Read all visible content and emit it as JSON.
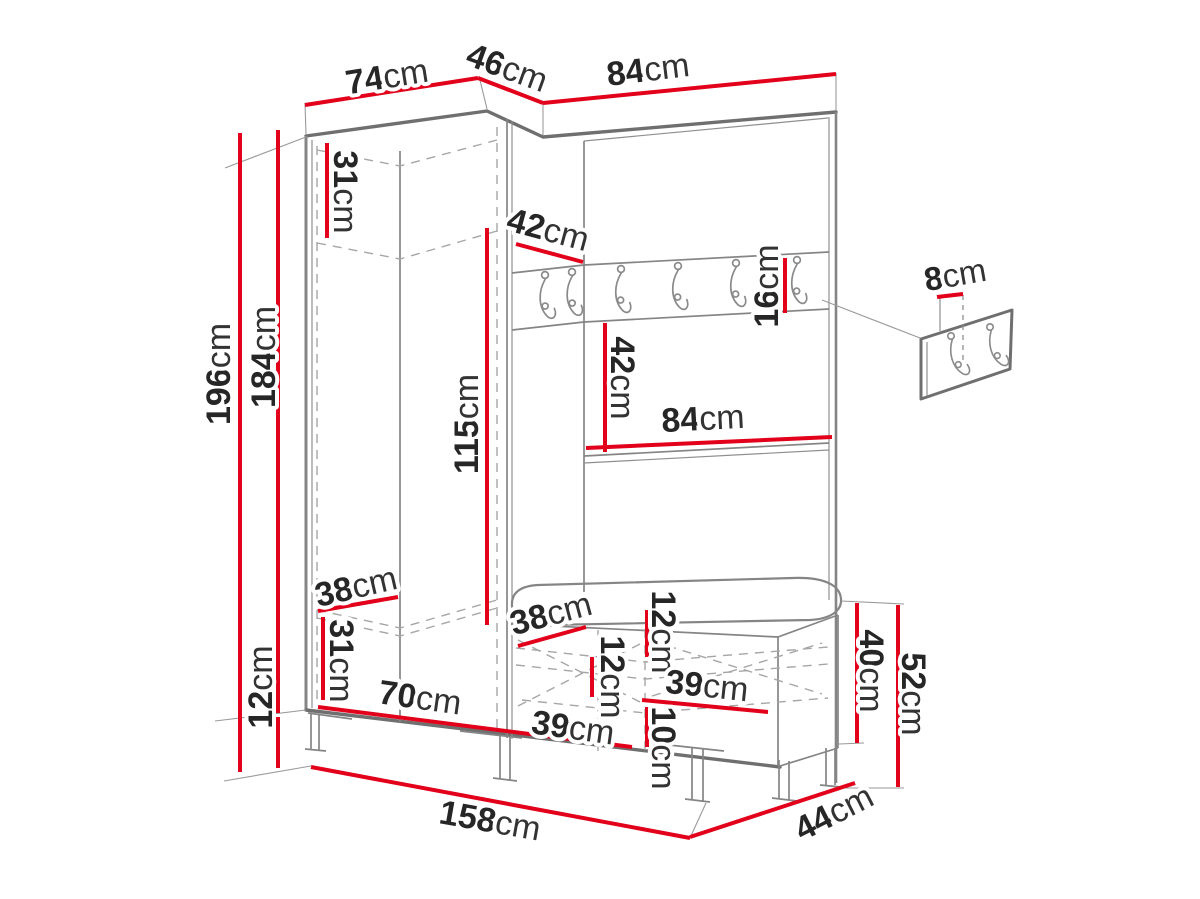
{
  "colors": {
    "dimension_red": "#e2001a",
    "drawing_gray": "#858585",
    "outline_gray": "#6f6f6f",
    "dashed_gray": "#a6a6a6",
    "label_dark": "#262626",
    "background": "#ffffff"
  },
  "dimensions": {
    "wardrobe_width_top": {
      "v": "74",
      "u": "cm"
    },
    "corner_width_top": {
      "v": "46",
      "u": "cm"
    },
    "panel_width_top": {
      "v": "84",
      "u": "cm"
    },
    "top_shelf_height": {
      "v": "31",
      "u": "cm"
    },
    "corner_shelf_depth": {
      "v": "42",
      "u": "cm"
    },
    "hook_rail_height": {
      "v": "16",
      "u": "cm"
    },
    "hook_panel_height": {
      "v": "8",
      "u": "cm"
    },
    "total_height": {
      "v": "196",
      "u": "cm"
    },
    "cabinet_height": {
      "v": "184",
      "u": "cm"
    },
    "hanging_space_height": {
      "v": "115",
      "u": "cm"
    },
    "open_shelf_height": {
      "v": "42",
      "u": "cm"
    },
    "shelf_width": {
      "v": "84",
      "u": "cm"
    },
    "wardrobe_depth": {
      "v": "38",
      "u": "cm"
    },
    "bottom_shelf_height": {
      "v": "31",
      "u": "cm"
    },
    "wardrobe_inner_width": {
      "v": "70",
      "u": "cm"
    },
    "leg_height": {
      "v": "12",
      "u": "cm"
    },
    "bench_inner_depth": {
      "v": "38",
      "u": "cm"
    },
    "seat_height": {
      "v": "12",
      "u": "cm"
    },
    "drawer_front_height": {
      "v": "12",
      "u": "cm"
    },
    "drawer_width_right": {
      "v": "39",
      "u": "cm"
    },
    "drawer_lower_height": {
      "v": "10",
      "u": "cm"
    },
    "drawer_width_left": {
      "v": "39",
      "u": "cm"
    },
    "bench_body_height": {
      "v": "40",
      "u": "cm"
    },
    "bench_total_height": {
      "v": "52",
      "u": "cm"
    },
    "bench_depth": {
      "v": "44",
      "u": "cm"
    },
    "total_width": {
      "v": "158",
      "u": "cm"
    }
  }
}
